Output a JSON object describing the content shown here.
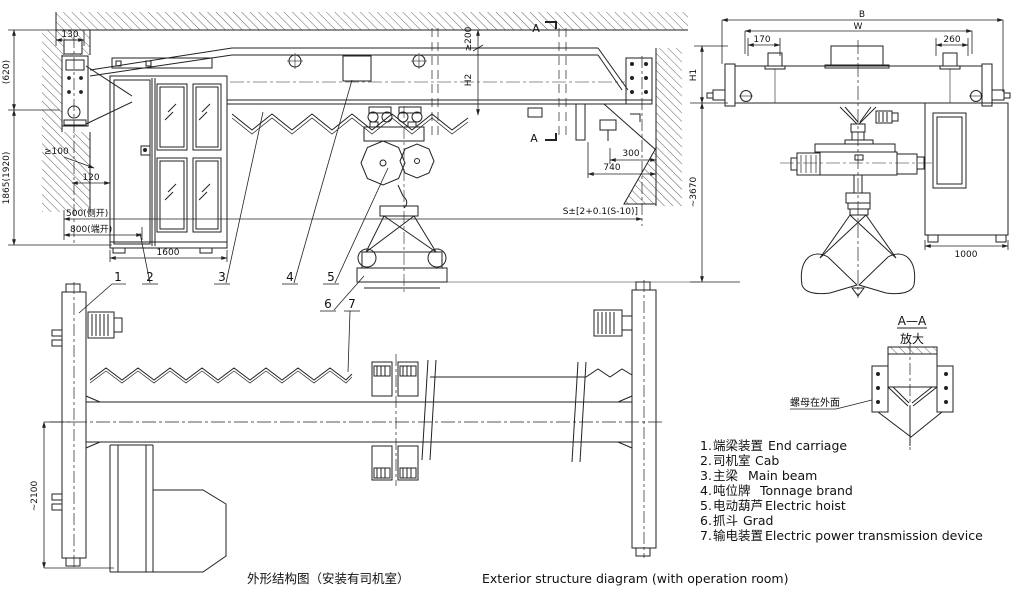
{
  "drawing": {
    "caption": {
      "cn": "外形结构图（安装有司机室）",
      "en": "Exterior structure diagram (with operation room)"
    },
    "side_view": {
      "section_mark": "A",
      "dims": {
        "d130": "130",
        "d620": "(620)",
        "d1865": "1865(1920)",
        "dge100": "≥100",
        "d120": "120",
        "d500": "500(侧开)",
        "d800": "800(端开)",
        "d1600": "1600",
        "dge200": "≥200",
        "dH2": "H2",
        "d300": "300",
        "d740": "740",
        "dS": "S±[2+0.1(S-10)]"
      }
    },
    "end_view": {
      "dims": {
        "dB": "B",
        "dW": "W",
        "d170": "170",
        "d260": "260",
        "dH1": "H1",
        "d3670": "~3670",
        "d1000": "1000"
      }
    },
    "plan_view": {
      "dims": {
        "d2100": "~2100"
      }
    },
    "detail_view": {
      "title": "A—A",
      "subtitle": "放大",
      "note": "螺母在外面"
    },
    "callouts": [
      "1",
      "2",
      "3",
      "4",
      "5",
      "6",
      "7"
    ],
    "legend": {
      "items": [
        {
          "no": "1.",
          "cn": "端梁装置",
          "en": "End carriage"
        },
        {
          "no": "2.",
          "cn": "司机室",
          "en": "Cab"
        },
        {
          "no": "3.",
          "cn": "主梁",
          "en": "Main beam"
        },
        {
          "no": "4.",
          "cn": "吨位牌",
          "en": "Tonnage brand"
        },
        {
          "no": "5.",
          "cn": "电动葫芦",
          "en": "Electric hoist"
        },
        {
          "no": "6.",
          "cn": "抓斗",
          "en": "Grad"
        },
        {
          "no": "7.",
          "cn": "输电装置",
          "en": "Electric power transmission device"
        }
      ]
    },
    "colors": {
      "line": "#222222",
      "background": "#ffffff"
    }
  }
}
